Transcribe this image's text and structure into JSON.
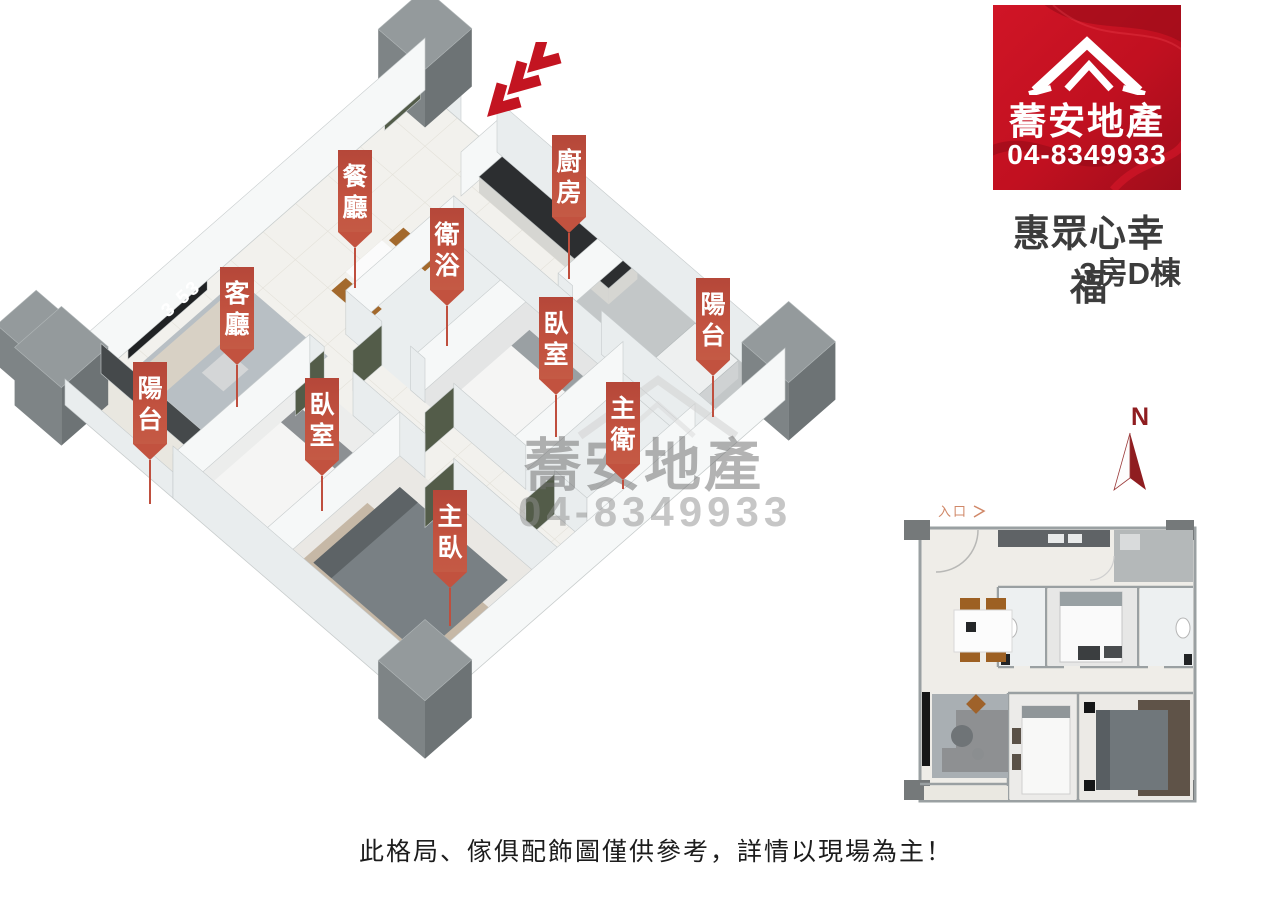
{
  "brand": {
    "name": "蕎安地產",
    "phone": "04-8349933"
  },
  "listing": {
    "title": "惠眾心幸福",
    "subtitle": "3房D棟"
  },
  "rooms": [
    {
      "id": "dining",
      "name": "餐廳"
    },
    {
      "id": "kitchen",
      "name": "廚房"
    },
    {
      "id": "bathroom",
      "name": "衛浴"
    },
    {
      "id": "living",
      "name": "客廳"
    },
    {
      "id": "balcony-right",
      "name": "陽台"
    },
    {
      "id": "bedroom-top",
      "name": "臥室"
    },
    {
      "id": "balcony-left",
      "name": "陽台"
    },
    {
      "id": "bedroom-left",
      "name": "臥室"
    },
    {
      "id": "master-bath",
      "name": "主衛"
    },
    {
      "id": "master-bedroom",
      "name": "主臥"
    }
  ],
  "compass": {
    "label": "N"
  },
  "mini_plan": {
    "entrance_label": "入口"
  },
  "watermark": {
    "name": "蕎安地產",
    "phone": "04-8349933"
  },
  "disclaimer": "此格局、傢俱配飾圖僅供參考，詳情以現場為主！",
  "clock_text": "3 53",
  "colors": {
    "label_red": "#bf4f3e",
    "logo_red": "#c3101f",
    "compass_red": "#8f1d20",
    "title_text": "#3c3c3c"
  }
}
